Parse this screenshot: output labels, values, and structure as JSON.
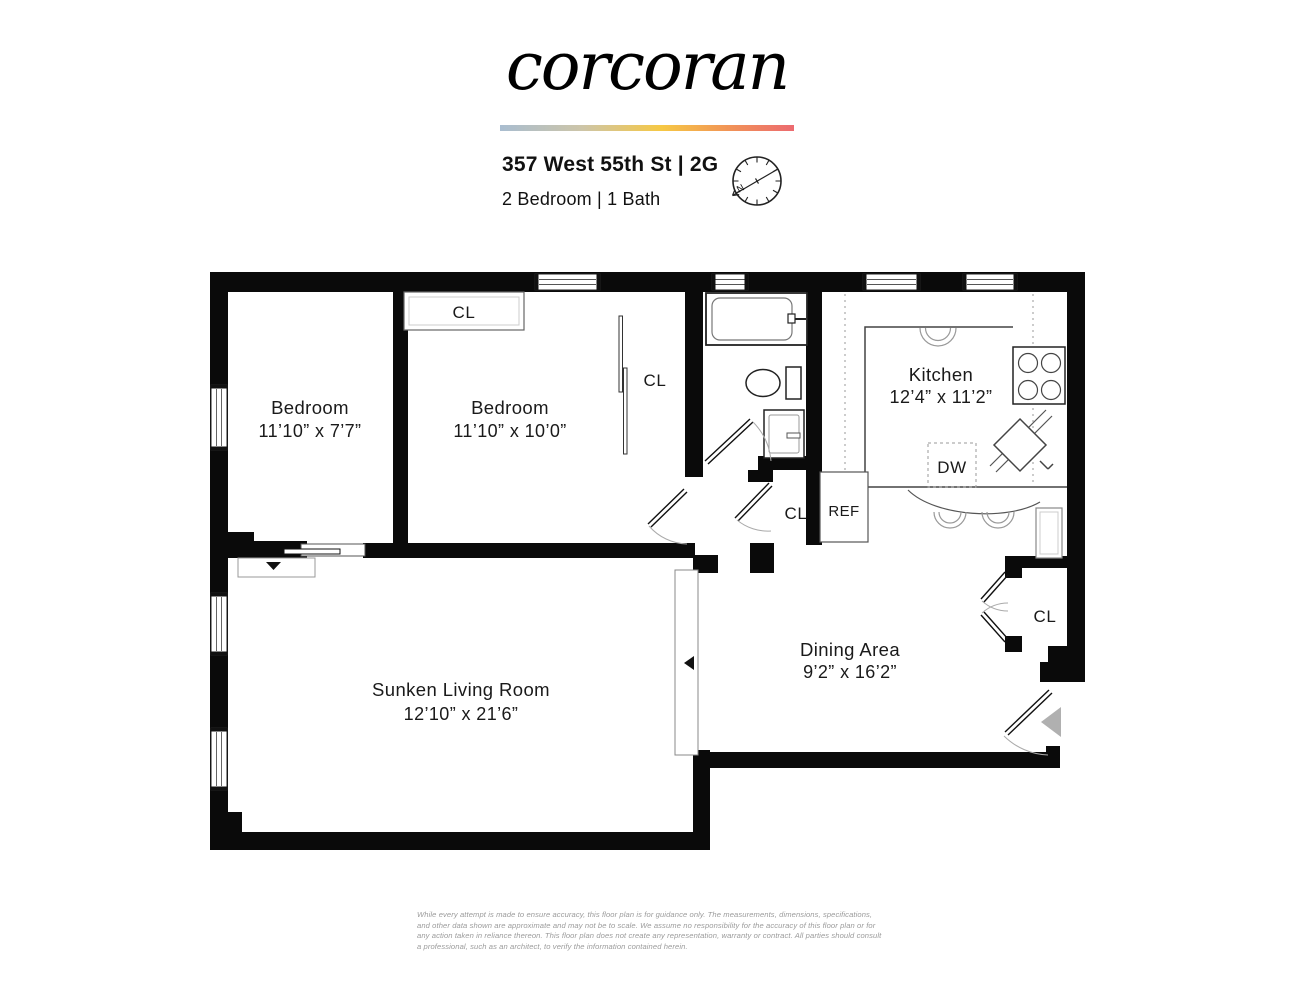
{
  "brand": {
    "logo_text": "corcoran",
    "gradient_colors": [
      "#a9bdd0",
      "#cdc5a8",
      "#f6c844",
      "#f19357",
      "#ec6a70"
    ]
  },
  "header": {
    "address": "357 West 55th St | 2G",
    "unit_info": "2 Bedroom | 1 Bath"
  },
  "compass": {
    "north_label": "N"
  },
  "rooms": [
    {
      "name": "Bedroom",
      "dimensions": "11’10” x 7’7”"
    },
    {
      "name": "Bedroom",
      "dimensions": "11’10” x 10’0”"
    },
    {
      "name": "Kitchen",
      "dimensions": "12’4” x 11’2”"
    },
    {
      "name": "Dining Area",
      "dimensions": "9’2” x 16’2”"
    },
    {
      "name": "Sunken Living Room",
      "dimensions": "12’10” x 21’6”"
    }
  ],
  "labels": {
    "closet": "CL",
    "dishwasher": "DW",
    "refrigerator": "REF"
  },
  "colors": {
    "wall": "#0a0a0a",
    "entry_arrow": "#b0b0b0"
  },
  "footer": {
    "disclaimer": "While every attempt is made to ensure accuracy, this floor plan is for guidance only. The measurements, dimensions, specifications, and other data shown are approximate and may not be to scale. We assume no responsibility for the accuracy of this floor plan or for any action taken in reliance thereon. This floor plan does not create any representation, warranty or contract. All parties should consult a professional, such as an architect, to verify the information contained herein."
  }
}
